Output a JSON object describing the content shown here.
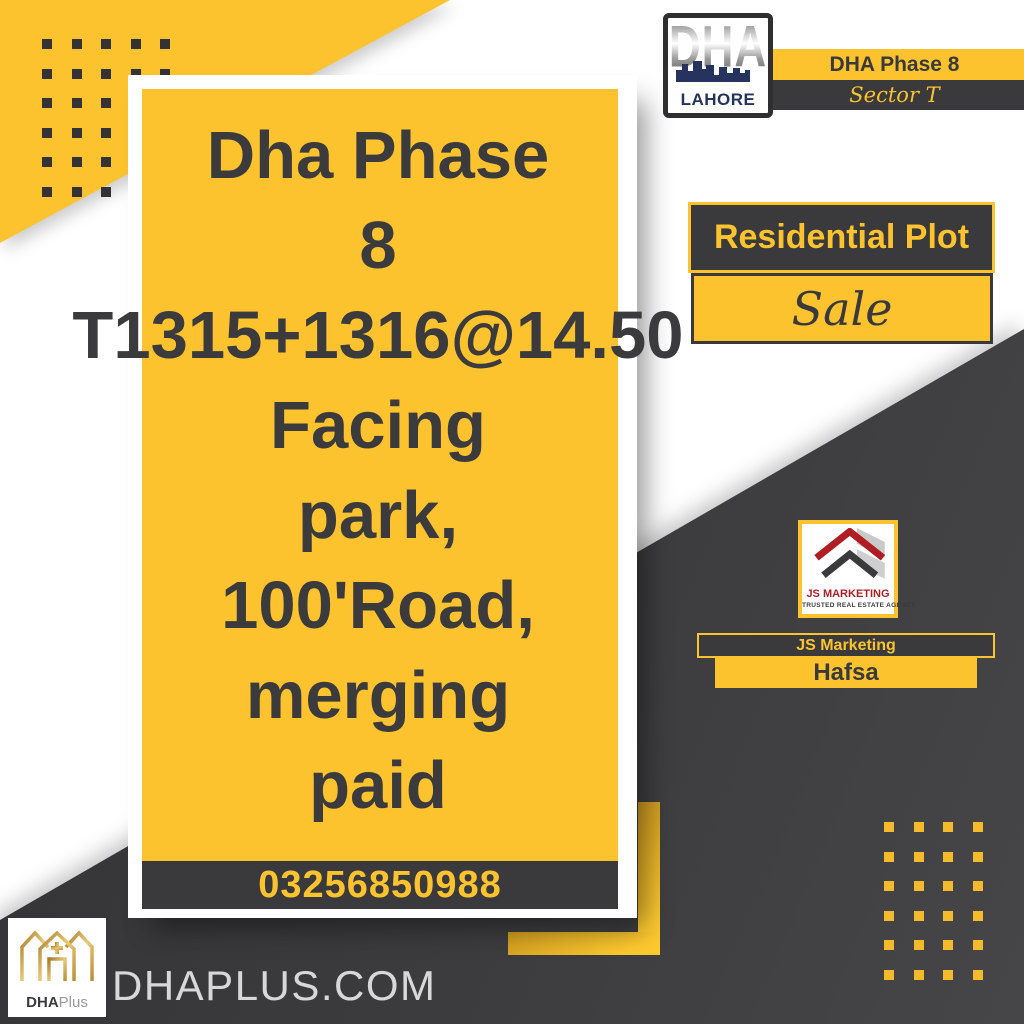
{
  "header_right": {
    "logo": {
      "title": "DHA",
      "city": "LAHORE"
    },
    "phase": "DHA Phase 8",
    "sector": "Sector T"
  },
  "card": {
    "lines": [
      "Dha Phase",
      "8",
      "T1315+1316@14.50",
      "Facing",
      "park,",
      "100'Road,",
      "merging",
      "paid"
    ],
    "phone": "03256850988"
  },
  "badges": {
    "category": "Residential Plot",
    "action": "Sale"
  },
  "agency": {
    "name": "JS MARKETING",
    "tagline": "TRUSTED REAL ESTATE AGENCY",
    "display_name": "JS Marketing",
    "agent": "Hafsa"
  },
  "footer": {
    "brand_bold": "DHA",
    "brand_light": "Plus",
    "website": "DHAPLUS.COM"
  },
  "colors": {
    "yellow": "#FCC32F",
    "dark": "#3A3A3C",
    "navy": "#26335E",
    "red": "#B01E23",
    "gold": "#C79A3B"
  }
}
